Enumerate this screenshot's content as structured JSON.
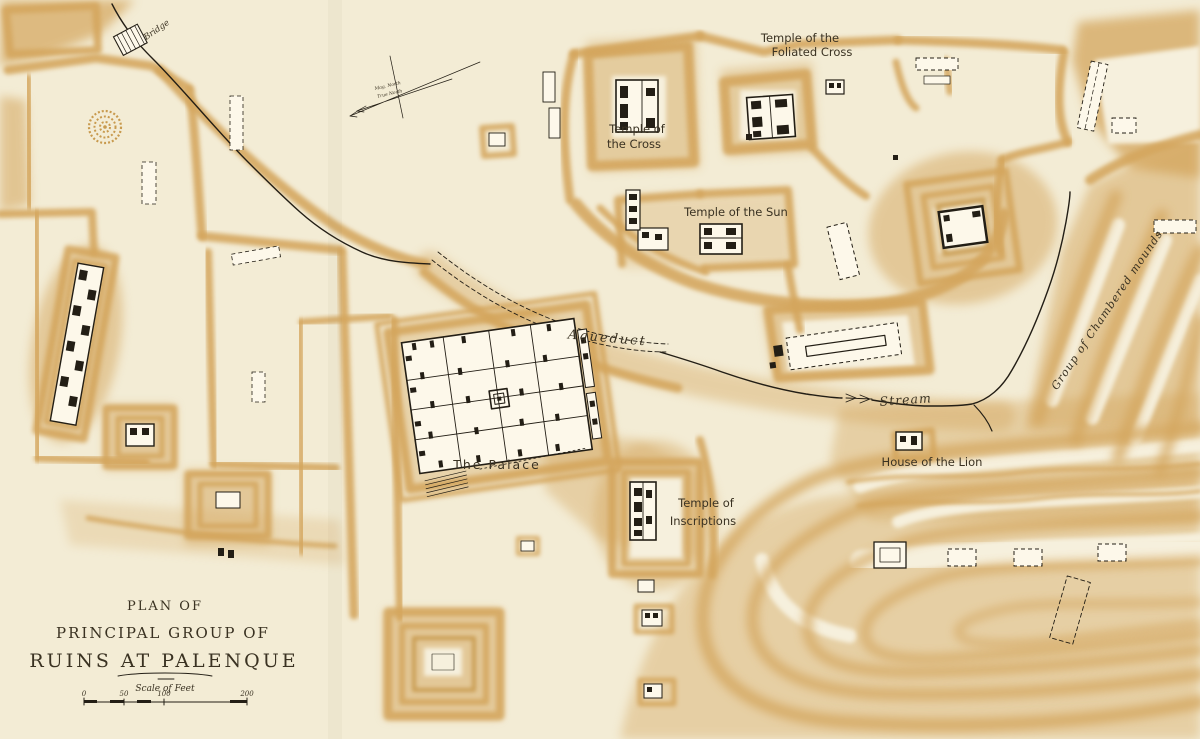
{
  "map_title": {
    "line1": "PLAN OF",
    "line2": "PRINCIPAL GROUP OF",
    "line3": "RUINS AT PALENQUE"
  },
  "scale_bar": {
    "caption": "Scale of Feet",
    "ticks": [
      "0",
      "50",
      "100",
      "200"
    ]
  },
  "compass": {
    "magnetic_label": "Mag. North",
    "true_label": "True North"
  },
  "labels": {
    "bridge": "Bridge",
    "temple_of_the_foliated_cross_line1": "Temple of the",
    "temple_of_the_foliated_cross_line2": "Foliated Cross",
    "temple_of_the_cross_line1": "Temple of",
    "temple_of_the_cross_line2": "the Cross",
    "temple_of_the_sun": "Temple of the Sun",
    "aqueduct": "Aqueduct",
    "stream": "Stream",
    "house_of_the_lion": "House of the Lion",
    "the_palace": "The Palace",
    "temple_of_inscriptions_line1": "Temple of",
    "temple_of_inscriptions_line2": "Inscriptions",
    "group_of_chambered_mounds": "Group of Chambered mounds"
  },
  "colors": {
    "paper": "#f3ecd5",
    "paper2": "#f6f0dd",
    "mound": "#d4a65d",
    "mound_deep": "#c3923f",
    "ink": "#231e15",
    "ink2": "#3a3222"
  }
}
